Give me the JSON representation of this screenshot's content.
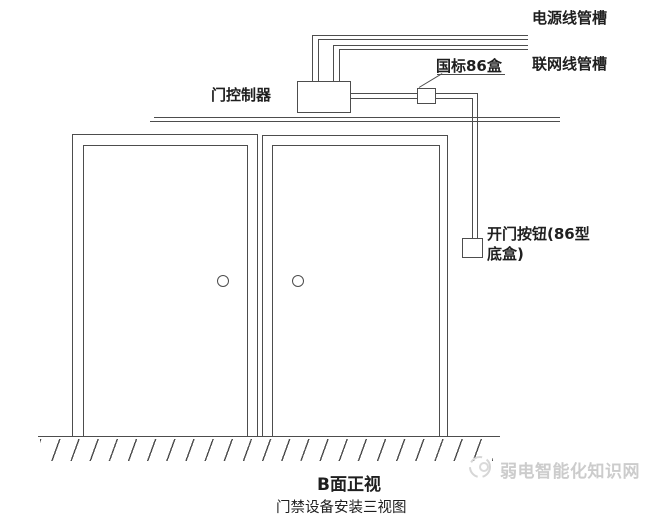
{
  "colors": {
    "line": "#4d4d4d",
    "text": "#1f1f1f",
    "watermark": "#cccccc",
    "background": "#ffffff"
  },
  "annotations": {
    "power_conduit": "电源线管槽",
    "network_conduit": "联网线管槽",
    "gb86_box": "国标86盒",
    "door_controller": "门控制器",
    "exit_button_line1": "开门按钮(86型",
    "exit_button_line2": "底盒)"
  },
  "footer": {
    "view_label": "B面正视",
    "caption": "门禁设备安装三视图"
  },
  "watermark": {
    "text": "弱电智能化知识网"
  }
}
